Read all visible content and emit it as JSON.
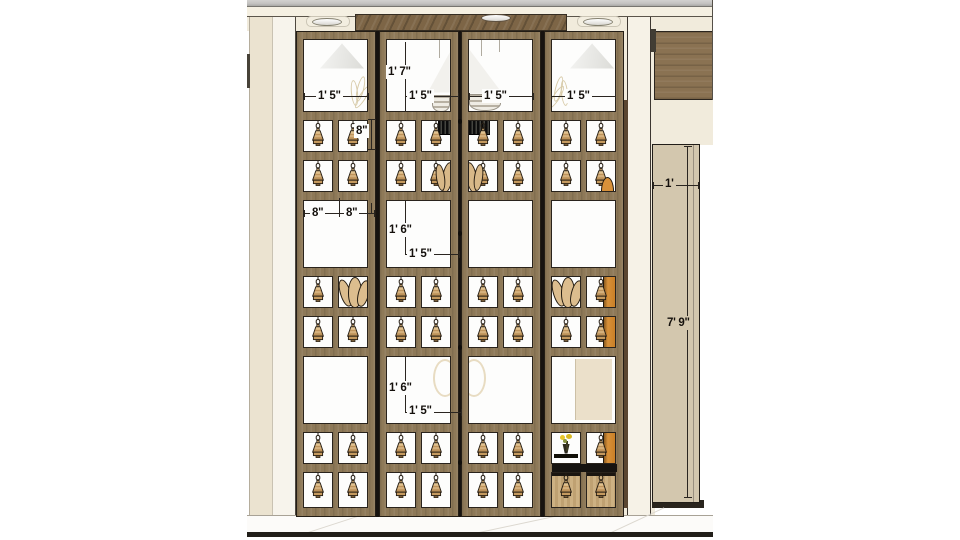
{
  "scene": {
    "type": "architectural-elevation-drawing",
    "subject": "Four-panel wooden partition screen with grid of hanging bells, side wall panel and dimension annotations"
  },
  "colors": {
    "frame_wood": "#8e7958",
    "header_wood": "#7d6546",
    "wall_cream": "#f1ebdc",
    "side_panel_beige": "#d3c7ae",
    "glass_white": "#fdfdfc",
    "bell_brass": "#d9b57e",
    "accent_orange": "#d8913a",
    "dim_line": "#2a2520",
    "floor": "#fcfbf9",
    "top_strip_gray": "#c3c2c0",
    "right_wood_panel": "#8a7252"
  },
  "dims": {
    "top_h": "1' 7\"",
    "w1": "1' 5\"",
    "w2": "1' 5\"",
    "w3": "1' 5\"",
    "w4": "1' 5\"",
    "cell_h": "8\"",
    "cw1": "8\"",
    "cw2": "8\"",
    "mid1_h": "1' 6\"",
    "mid1_w": "1' 5\"",
    "mid2_h": "1' 6\"",
    "mid2_w": "1' 5\"",
    "side_w": "1'",
    "side_h": "7' 9\""
  },
  "screen": {
    "geometry": {
      "x": 296,
      "y": 31,
      "w": 328.2,
      "h": 486,
      "panel_w": 80,
      "panel_xs": [
        0,
        82.7,
        165.4,
        248.1
      ]
    },
    "rows": [
      {
        "t": "open",
        "h": 73,
        "decor": [
          "lampP1",
          "chandR",
          "chandL",
          "lampP4"
        ]
      },
      {
        "t": "rail",
        "h": 8
      },
      {
        "t": "bells",
        "h": 32,
        "cells": [
          [
            "bell",
            "bell"
          ],
          [
            "bell",
            "bell_boxR"
          ],
          [
            "bell_boxL",
            "bell"
          ],
          [
            "bell",
            "bell"
          ]
        ]
      },
      {
        "t": "rail",
        "h": 8
      },
      {
        "t": "bells",
        "h": 32,
        "cells": [
          [
            "bell",
            "bell"
          ],
          [
            "bell",
            "swirlR"
          ],
          [
            "swirlL",
            "bell"
          ],
          [
            "bell",
            "bell_arc"
          ]
        ]
      },
      {
        "t": "rail",
        "h": 8
      },
      {
        "t": "open",
        "h": 68,
        "decor": [
          null,
          null,
          null,
          null
        ]
      },
      {
        "t": "rail",
        "h": 8
      },
      {
        "t": "bells",
        "h": 32,
        "cells": [
          [
            "bell",
            "shells"
          ],
          [
            "bell",
            "bell"
          ],
          [
            "bell",
            "bell"
          ],
          [
            "shells",
            "bell_orange"
          ]
        ]
      },
      {
        "t": "rail",
        "h": 8
      },
      {
        "t": "bells",
        "h": 32,
        "cells": [
          [
            "bell",
            "bell"
          ],
          [
            "bell",
            "bell"
          ],
          [
            "bell",
            "bell"
          ],
          [
            "bell",
            "bell_orange"
          ]
        ]
      },
      {
        "t": "rail",
        "h": 8
      },
      {
        "t": "open",
        "h": 68,
        "decor": [
          null,
          "arcsR",
          "arcsL",
          "tanrect"
        ]
      },
      {
        "t": "rail",
        "h": 8
      },
      {
        "t": "bells",
        "h": 32,
        "cells": [
          [
            "bell",
            "bell"
          ],
          [
            "bell",
            "bell"
          ],
          [
            "bell",
            "bell"
          ],
          [
            "flowers",
            "bell_orange"
          ]
        ]
      },
      {
        "t": "rail",
        "h": 8
      },
      {
        "t": "bells",
        "h": 36,
        "cells": [
          [
            "bell",
            "bell"
          ],
          [
            "bell",
            "bell"
          ],
          [
            "bell",
            "bell"
          ],
          [
            "drawer_bell",
            "drawer_bell"
          ]
        ]
      }
    ]
  }
}
